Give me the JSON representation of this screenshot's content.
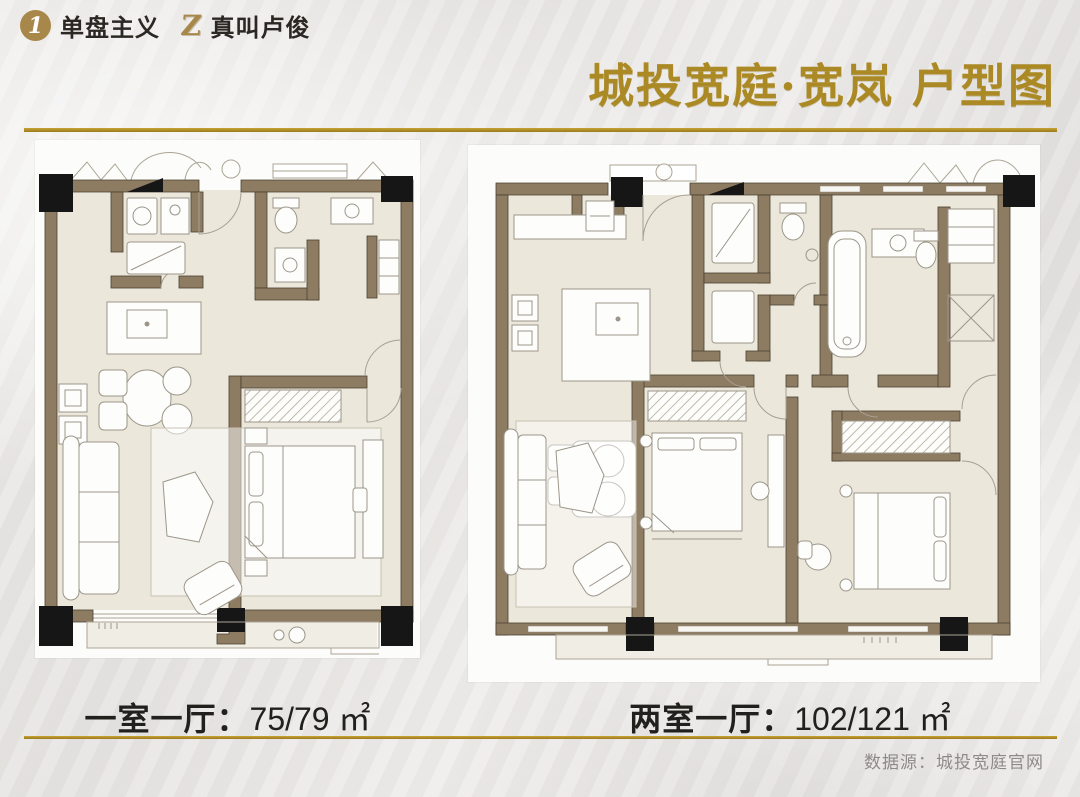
{
  "header": {
    "logo1_glyph": "1",
    "brand1": "单盘主义",
    "logo2_glyph": "Z",
    "brand2": "真叫卢俊",
    "title": "城投宽庭·宽岚 户型图"
  },
  "plans": [
    {
      "id": "one-bedroom",
      "label": "一室一厅：",
      "area": "75/79 ㎡"
    },
    {
      "id": "two-bedroom",
      "label": "两室一厅：",
      "area": "102/121 ㎡"
    }
  ],
  "footer": {
    "source": "数据源：城投宽庭官网"
  },
  "colors": {
    "gold": "#ab8a25",
    "rule_gold": "#b5942c",
    "logo_gold": "#a8874a",
    "text_dark": "#2b2824",
    "source_gray": "#8e8b87",
    "wall_brown": "#8d7b62",
    "floor_beige": "#ebe7da",
    "column_black": "#161616"
  }
}
